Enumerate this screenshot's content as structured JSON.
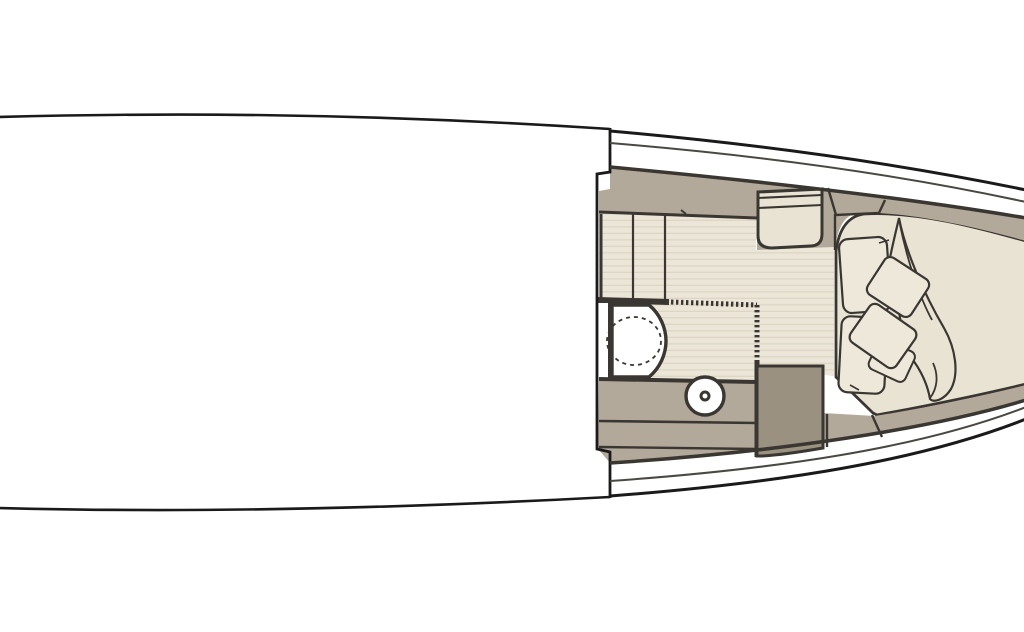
{
  "meta": {
    "description": "Yacht bow cabin floor plan, top view: companionway steps, head compartment with toilet and washbasin, storage cabinet, and V-berth with pillows and blanket"
  },
  "colors": {
    "hull": "#1a1a1a",
    "deck_line": "#4a4843",
    "wall": "#3a3732",
    "taupe": "#b3a99a",
    "taupe_dark": "#9b9181",
    "cream": "#e9e3d3",
    "floor": "#ece6d8",
    "floor_stripe": "#ddd6c5",
    "pillow": "#ede8d9",
    "white": "#ffffff"
  },
  "features": [
    "hull-outline",
    "side-deck",
    "cabin-bulkhead",
    "companionway-steps",
    "storage-cabinet",
    "head-compartment",
    "toilet",
    "washbasin",
    "shower-partition",
    "vanity-counter",
    "berth-step",
    "v-berth",
    "pillow",
    "cushion",
    "blanket",
    "hull-shelf"
  ]
}
